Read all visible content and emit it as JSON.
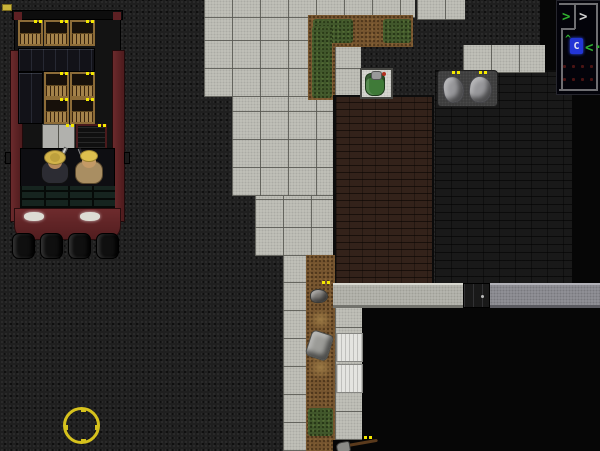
{
  "scene": {
    "description": "top-down zombie survival game street scene",
    "canvas": {
      "w": 600,
      "h": 451
    }
  },
  "palette": {
    "asphalt": "#1f1f1f",
    "unexplored_black": "#060606",
    "sidewalk_concrete": "#c3c3bb",
    "wood_floor": "#33221a",
    "dark_brick_floor": "#191919",
    "dirt": "#76552f",
    "grass": "#41572b",
    "wall_light": "#b9b9b1",
    "wall_dark": "#94949a",
    "truck_red": "#5d2023",
    "crate_wood": "#8d6c38",
    "loot_marker_yellow": "#f4e800",
    "cursor_yellow": "#d6c21d",
    "minimap_player_blue": "#2336d6",
    "minimap_green": "#2fae2f",
    "minimap_dot_red": "#4a1414"
  },
  "terrain": [
    {
      "name": "sidewalk-top-strip",
      "type": "tiles",
      "x": 204,
      "y": 0,
      "w": 211,
      "h": 18
    },
    {
      "name": "sidewalk-top-right-pair",
      "type": "tiles",
      "x": 417,
      "y": 0,
      "w": 48,
      "h": 20
    },
    {
      "name": "sidewalk-main-upper",
      "type": "tiles",
      "x": 204,
      "y": 18,
      "w": 106,
      "h": 79
    },
    {
      "name": "sidewalk-main-mid",
      "type": "tiles",
      "x": 232,
      "y": 97,
      "w": 101,
      "h": 99
    },
    {
      "name": "sidewalk-main-lower",
      "type": "tiles",
      "x": 255,
      "y": 196,
      "w": 78,
      "h": 60
    },
    {
      "name": "sidewalk-column-left",
      "type": "tiles",
      "x": 283,
      "y": 256,
      "w": 27,
      "h": 195
    },
    {
      "name": "dirt-bed-top",
      "type": "dirt",
      "x": 308,
      "y": 15,
      "w": 105,
      "h": 32
    },
    {
      "name": "dirt-bed-top-leg",
      "type": "dirt",
      "x": 308,
      "y": 15,
      "w": 27,
      "h": 85
    },
    {
      "name": "grass-top-a",
      "type": "grass",
      "x": 313,
      "y": 19,
      "w": 40,
      "h": 24
    },
    {
      "name": "grass-top-b",
      "type": "grass",
      "x": 383,
      "y": 19,
      "w": 28,
      "h": 24
    },
    {
      "name": "grass-top-leg",
      "type": "grass",
      "x": 312,
      "y": 26,
      "w": 20,
      "h": 72
    },
    {
      "name": "concrete-by-backpack",
      "type": "tiles",
      "x": 335,
      "y": 47,
      "w": 26,
      "h": 50
    },
    {
      "name": "wood-floor-room",
      "type": "wood",
      "x": 333,
      "y": 95,
      "w": 101,
      "h": 190
    },
    {
      "name": "dark-brick-room",
      "type": "brick",
      "x": 435,
      "y": 70,
      "w": 137,
      "h": 215
    },
    {
      "name": "unexplored-top-right",
      "type": "black",
      "x": 540,
      "y": 0,
      "w": 60,
      "h": 70
    },
    {
      "name": "unexplored-right-strip",
      "type": "black",
      "x": 572,
      "y": 0,
      "w": 28,
      "h": 310
    },
    {
      "name": "concrete-slab-top-right",
      "type": "tiles",
      "x": 463,
      "y": 45,
      "w": 82,
      "h": 28
    },
    {
      "name": "pickup-mat",
      "type": "mat",
      "x": 437,
      "y": 70,
      "w": 61,
      "h": 37
    },
    {
      "name": "dirt-path-bottom",
      "type": "dirt",
      "x": 306,
      "y": 255,
      "w": 29,
      "h": 196
    },
    {
      "name": "grass-bottom-patch",
      "type": "grass",
      "x": 308,
      "y": 408,
      "w": 25,
      "h": 28
    },
    {
      "name": "sidewalk-column-right",
      "type": "tiles",
      "x": 335,
      "y": 308,
      "w": 27,
      "h": 132
    },
    {
      "name": "wall-top-light",
      "type": "wall-l",
      "x": 333,
      "y": 283,
      "w": 130,
      "h": 25
    },
    {
      "name": "wall-top-dark",
      "type": "wall-d",
      "x": 490,
      "y": 283,
      "w": 110,
      "h": 25
    },
    {
      "name": "unexplored-bottom",
      "type": "black",
      "x": 362,
      "y": 308,
      "w": 238,
      "h": 143
    },
    {
      "name": "unexplored-below-column",
      "type": "black",
      "x": 333,
      "y": 440,
      "w": 29,
      "h": 11
    },
    {
      "name": "mattress-a",
      "type": "wmat",
      "x": 336,
      "y": 333,
      "w": 27,
      "h": 29
    },
    {
      "name": "mattress-b",
      "type": "wmat",
      "x": 336,
      "y": 364,
      "w": 27,
      "h": 29
    },
    {
      "name": "backpack-tile",
      "type": "wtile",
      "x": 360,
      "y": 68,
      "w": 33,
      "h": 31
    }
  ],
  "markers": {
    "color": "#f4e800",
    "positions": [
      [
        34,
        20
      ],
      [
        60,
        20
      ],
      [
        86,
        20
      ],
      [
        60,
        72
      ],
      [
        86,
        72
      ],
      [
        60,
        98
      ],
      [
        86,
        98
      ],
      [
        66,
        124
      ],
      [
        98,
        124
      ],
      [
        452,
        71
      ],
      [
        479,
        71
      ],
      [
        322,
        281
      ],
      [
        364,
        436
      ]
    ]
  },
  "minimap": {
    "x": 556,
    "y": 0,
    "w": 44,
    "h": 93,
    "bg": "#03030a",
    "line_color": "#6e6e72",
    "lines": [
      {
        "x": 2,
        "y": 2,
        "w": 39,
        "h": 2
      },
      {
        "x": 39,
        "y": 2,
        "w": 2,
        "h": 88
      },
      {
        "x": 2,
        "y": 88,
        "w": 39,
        "h": 2
      },
      {
        "x": 17,
        "y": 4,
        "w": 2,
        "h": 24
      },
      {
        "x": 4,
        "y": 27,
        "w": 14,
        "h": 2
      },
      {
        "x": 4,
        "y": 27,
        "w": 2,
        "h": 61
      }
    ],
    "glyphs": [
      {
        "name": "survivor-arrow-green-1",
        "char": ">",
        "color": "#2fae2f",
        "x": 5,
        "y": 9,
        "size": 14
      },
      {
        "name": "survivor-arrow-white",
        "char": ">",
        "color": "#cfcfcf",
        "x": 22,
        "y": 9,
        "size": 14
      },
      {
        "name": "survivor-caret-green",
        "char": "^",
        "color": "#2fae2f",
        "x": 8,
        "y": 34,
        "size": 10
      },
      {
        "name": "survivor-arrow-green-2",
        "char": "<",
        "color": "#2fae2f",
        "x": 28,
        "y": 40,
        "size": 14
      },
      {
        "name": "survivor-dot-green",
        "char": ".",
        "color": "#2fae2f",
        "x": 37,
        "y": 36,
        "size": 14
      }
    ],
    "player": {
      "char": "C",
      "x": 13,
      "y": 37,
      "w": 13,
      "h": 16,
      "bg": "#2336d6",
      "color": "#eaeaf2"
    },
    "dots": {
      "color": "#4a1414",
      "positions": [
        [
          6,
          64
        ],
        [
          15,
          64
        ],
        [
          24,
          64
        ],
        [
          33,
          64
        ],
        [
          6,
          77
        ],
        [
          15,
          77
        ],
        [
          24,
          77
        ],
        [
          33,
          77
        ]
      ]
    }
  },
  "truck": {
    "crates": [
      [
        10,
        10
      ],
      [
        36,
        10
      ],
      [
        62,
        10
      ],
      [
        36,
        62
      ],
      [
        62,
        62
      ],
      [
        36,
        88
      ],
      [
        62,
        88
      ]
    ],
    "wheels": [
      4,
      32,
      60,
      88
    ]
  }
}
